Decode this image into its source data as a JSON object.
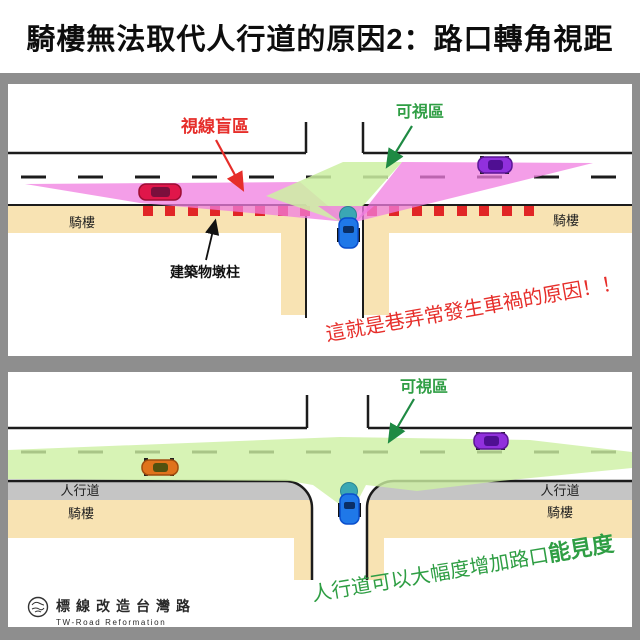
{
  "title": "騎樓無法取代人行道的原因2：路口轉角視距",
  "panel_top": {
    "blind_zone_label": "視線盲區",
    "visible_zone_label": "可視區",
    "arcade_left": "騎樓",
    "arcade_right": "騎樓",
    "pillar_label": "建築物墩柱",
    "caption": "這就是巷弄常發生車禍的原因！！"
  },
  "panel_bottom": {
    "visible_zone_label": "可視區",
    "sidewalk_left": "人行道",
    "sidewalk_right": "人行道",
    "arcade_left": "騎樓",
    "arcade_right": "騎樓",
    "caption_normal": "人行道可以大幅度增加路口",
    "caption_emphasis": "能見度"
  },
  "footer": {
    "brand_zh": "標線改造台灣路",
    "brand_en": "TW-Road Reformation"
  },
  "colors": {
    "blind_zone_pink": "#f07de0",
    "visible_zone_green": "#cdf0a2",
    "arcade_tan": "#f8e3b3",
    "sidewalk_gray": "#c5c5c5",
    "frame_gray": "#8e8e8e",
    "pillar_red": "#e12626",
    "caption_red": "#e62e2a",
    "caption_green": "#2f9e44",
    "observer_car_blue": "#1f78e8",
    "windshield_teal": "#3aa7b4"
  }
}
